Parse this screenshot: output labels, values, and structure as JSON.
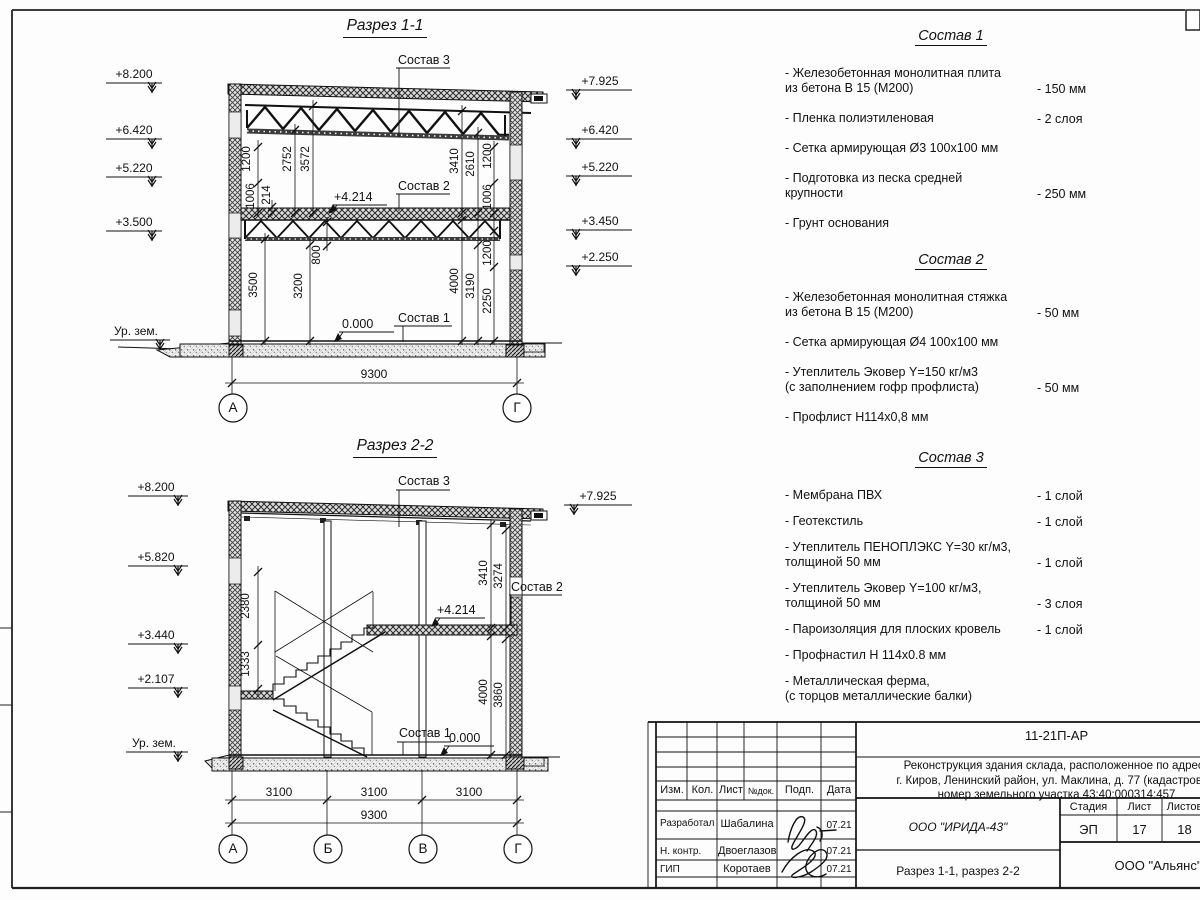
{
  "sec1": {
    "title": "Разрез 1-1",
    "elev": {
      "l1": "+8.200",
      "l2": "+6.420",
      "l3": "+5.220",
      "l4": "+3.500",
      "ground": "Ур. зем.",
      "r1": "+7.925",
      "r2": "+6.420",
      "r3": "+5.220",
      "r4": "+3.450",
      "r5": "+2.250"
    },
    "labels": {
      "sostav3": "Состав 3",
      "sostav2": "Состав 2",
      "sostav1": "Состав 1",
      "lvl": "+4.214",
      "zero": "0.000"
    },
    "dims": {
      "d1200a": "1200",
      "d1006a": "1006",
      "d214": "214",
      "d2752": "2752",
      "d3572": "3572",
      "d800": "800",
      "d3500": "3500",
      "d3200": "3200",
      "d3410": "3410",
      "d2610": "2610",
      "d1200b": "1200",
      "d1006b": "1006",
      "d1200c": "1200",
      "d2250": "2250",
      "d4000": "4000",
      "d3190": "3190",
      "total": "9300"
    },
    "axes": {
      "a": "А",
      "g": "Г"
    }
  },
  "sec2": {
    "title": "Разрез 2-2",
    "elev": {
      "l1": "+8.200",
      "l2": "+5.820",
      "l3": "+3.440",
      "l4": "+2.107",
      "ground": "Ур. зем.",
      "r1": "+7.925"
    },
    "labels": {
      "sostav3": "Состав 3",
      "sostav2": "Состав 2",
      "sostav1": "Состав 1",
      "lvl": "+4.214",
      "zero": "0.000"
    },
    "dims": {
      "d2380": "2380",
      "d1333": "1333",
      "d3410": "3410",
      "d3274": "3274",
      "d4000": "4000",
      "d3860": "3860",
      "b1": "3100",
      "b2": "3100",
      "b3": "3100",
      "total": "9300"
    },
    "axes": {
      "a": "А",
      "b": "Б",
      "v": "В",
      "g": "Г"
    }
  },
  "lists": [
    {
      "title": "Состав 1",
      "items": [
        {
          "text": "- Железобетонная  монолитная плита\n  из бетона В 15 (М200)",
          "value": "- 150 мм"
        },
        {
          "text": "- Пленка полиэтиленовая",
          "value": "-  2 слоя"
        },
        {
          "text": "- Сетка армирующая Ø3 100х100 мм",
          "value": ""
        },
        {
          "text": "- Подготовка из песка средней\n  крупности",
          "value": "- 250 мм"
        },
        {
          "text": "- Грунт основания",
          "value": ""
        }
      ]
    },
    {
      "title": "Состав 2",
      "items": [
        {
          "text": "- Железобетонная  монолитная стяжка\n  из бетона В 15 (М200)",
          "value": "- 50 мм"
        },
        {
          "text": "- Сетка армирующая Ø4 100х100 мм",
          "value": ""
        },
        {
          "text": "- Утеплитель Эковер Y=150 кг/м3\n  (с заполнением гофр профлиста)",
          "value": "- 50 мм"
        },
        {
          "text": "- Профлист Н114х0,8 мм",
          "value": ""
        }
      ]
    },
    {
      "title": "Состав 3",
      "items": [
        {
          "text": "- Мембрана ПВХ",
          "value": "- 1 слой"
        },
        {
          "text": "- Геотекстиль",
          "value": "- 1 слой"
        },
        {
          "text": "- Утеплитель ПЕНОПЛЭКС Y=30 кг/м3,\n  толщиной 50 мм",
          "value": "- 1 слой"
        },
        {
          "text": "- Утеплитель Эковер Y=100 кг/м3,\n  толщиной 50 мм",
          "value": "- 3 слоя"
        },
        {
          "text": "- Пароизоляция для плоских кровель",
          "value": "- 1 слой"
        },
        {
          "text": "- Профнастил Н 114х0.8 мм",
          "value": ""
        },
        {
          "text": "- Металлическая ферма,\n  (с торцов металлические балки)",
          "value": ""
        }
      ]
    }
  ],
  "stamp": {
    "code": "11-21П-АР",
    "desc": "Реконструкция здания склада, расположенное по адресу\nг. Киров, Ленинский район, ул. Маклина, д. 77 (кадастровый\nномер земельного участка 43:40:000314:457",
    "cols": {
      "izm": "Изм.",
      "kol": "Кол.",
      "list": "Лист",
      "ndok": "№док.",
      "podp": "Подп.",
      "data": "Дата"
    },
    "rows": [
      {
        "role": "Разработал",
        "name": "Шабалина",
        "date": "07.21"
      },
      {
        "role": "Н. контр.",
        "name": "Двоеглазов",
        "date": "07.21"
      },
      {
        "role": "ГИП",
        "name": "Коротаев",
        "date": "07.21"
      }
    ],
    "org": "ООО \"ИРИДА-43\"",
    "stage_label": "Стадия",
    "sheet_label": "Лист",
    "sheets_label": "Листов",
    "stage": "ЭП",
    "sheet": "17",
    "sheets": "18",
    "doc_title": "Разрез 1-1, разрез 2-2",
    "org2": "ООО \"Альянс\""
  }
}
